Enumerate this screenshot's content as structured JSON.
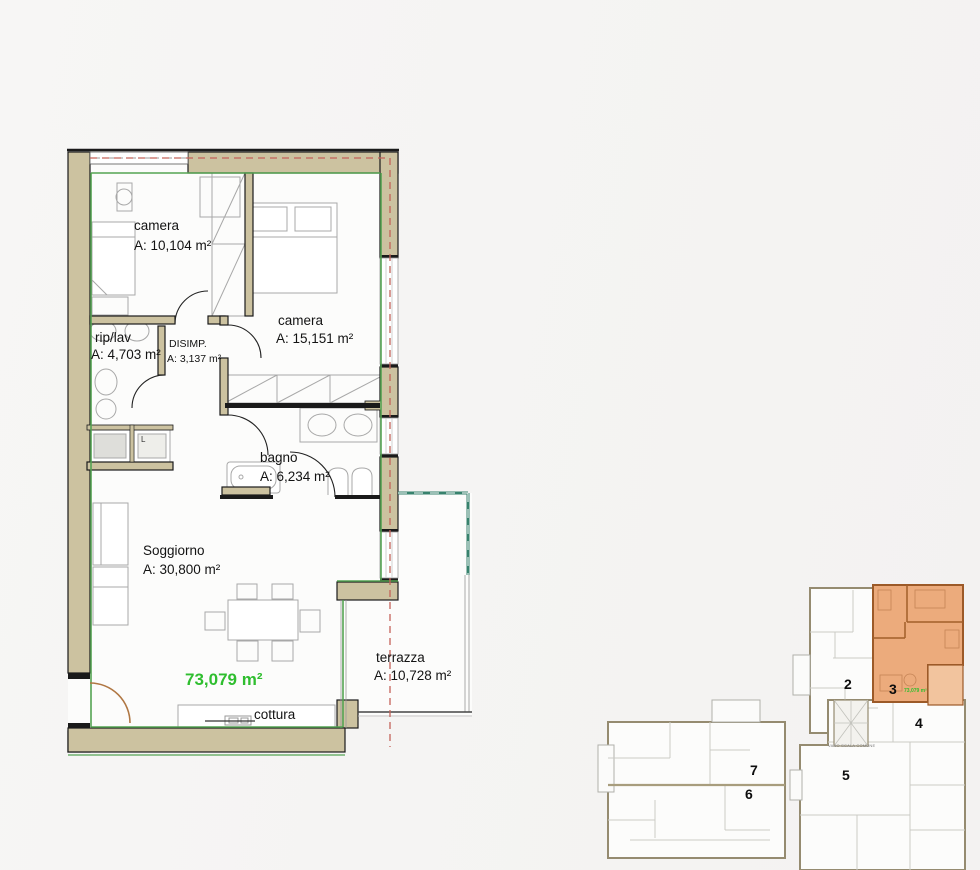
{
  "floor_plan": {
    "rooms": {
      "camera1": {
        "name": "camera",
        "area": "A: 10,104 m²"
      },
      "camera2": {
        "name": "camera",
        "area": "A: 15,151 m²"
      },
      "riplav": {
        "name": "rip/lav",
        "area": "A: 4,703 m²"
      },
      "disimp": {
        "name": "DISIMP.",
        "area": "A: 3,137 m²"
      },
      "bagno": {
        "name": "bagno",
        "area": "A: 6,234 m²"
      },
      "soggiorno": {
        "name": "Soggiorno",
        "area": "A: 30,800 m²"
      },
      "terrazza": {
        "name": "terrazza",
        "area": "A: 10,728 m²"
      },
      "cottura": {
        "name": "cottura"
      }
    },
    "total_area": "73,079 m²",
    "appliance_label": "L"
  },
  "minimap": {
    "units": {
      "u2": "2",
      "u3": "3",
      "u4": "4",
      "u5": "5",
      "u6": "6",
      "u7": "7"
    },
    "unit3_area": "73,079 m²",
    "stairwell_label": "VANO SCALA COMUNE"
  },
  "colors": {
    "wall_tan": "#ccc2a0",
    "highlight_orange_fill": "#ecab7c",
    "highlight_orange_wall": "#9c5a28",
    "perimeter_green": "#55a353",
    "total_green": "#2fbe2f",
    "projection_red_dashed": "#c4635a",
    "railing_teal": "#37826d"
  }
}
